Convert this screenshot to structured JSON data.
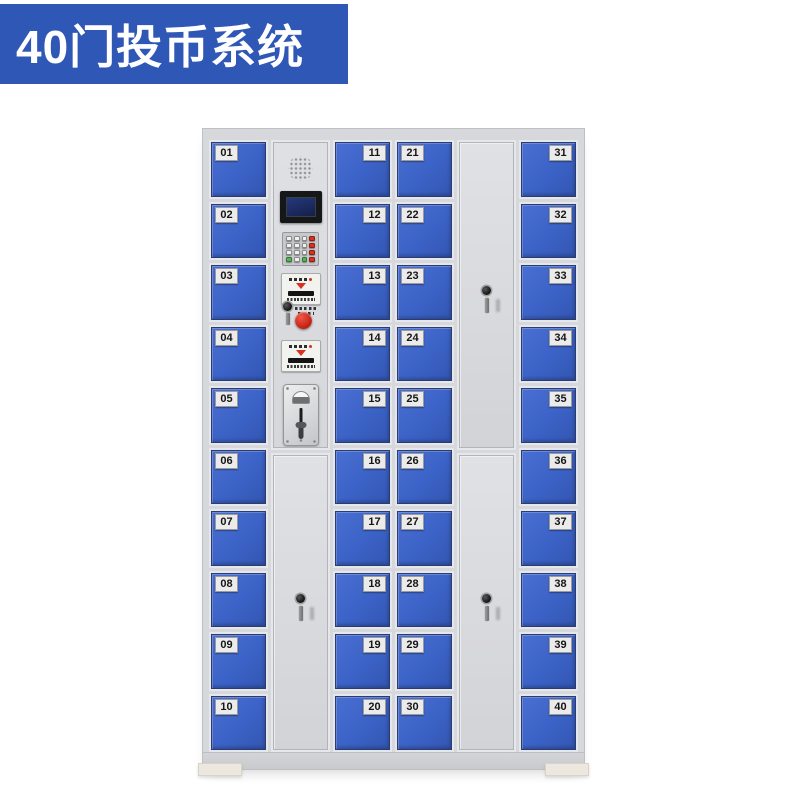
{
  "banner": {
    "title": "40门投币系统"
  },
  "colors": {
    "banner_bg": "#2f57b5",
    "banner_text": "#ffffff",
    "door_blue": "#3b62c6",
    "cabinet_grey": "#d7d8db",
    "accent_red": "#d8311f",
    "accent_green": "#58b358",
    "lcd_screen": "#141f4a"
  },
  "cabinet": {
    "door_count": 40,
    "columns": [
      {
        "type": "doors",
        "name": "door-column-01-10",
        "label_side": "left",
        "doors": [
          "01",
          "02",
          "03",
          "04",
          "05",
          "06",
          "07",
          "08",
          "09",
          "10"
        ]
      },
      {
        "type": "control",
        "name": "control-column",
        "components": [
          "speaker",
          "lcd-screen",
          "keypad",
          "card-reader-slot",
          "coin-return-button",
          "bill-acceptor-slot",
          "coin-acceptor"
        ],
        "blank_door_locks": 1
      },
      {
        "type": "doors",
        "name": "door-column-11-20",
        "label_side": "right",
        "doors": [
          "11",
          "12",
          "13",
          "14",
          "15",
          "16",
          "17",
          "18",
          "19",
          "20"
        ]
      },
      {
        "type": "doors",
        "name": "door-column-21-30",
        "label_side": "left",
        "doors": [
          "21",
          "22",
          "23",
          "24",
          "25",
          "26",
          "27",
          "28",
          "29",
          "30"
        ]
      },
      {
        "type": "blank",
        "name": "service-door-column",
        "sections": [
          {
            "locks": 1
          },
          {
            "locks": 1
          }
        ]
      },
      {
        "type": "doors",
        "name": "door-column-31-40",
        "label_side": "right",
        "doors": [
          "31",
          "32",
          "33",
          "34",
          "35",
          "36",
          "37",
          "38",
          "39",
          "40"
        ]
      }
    ]
  }
}
